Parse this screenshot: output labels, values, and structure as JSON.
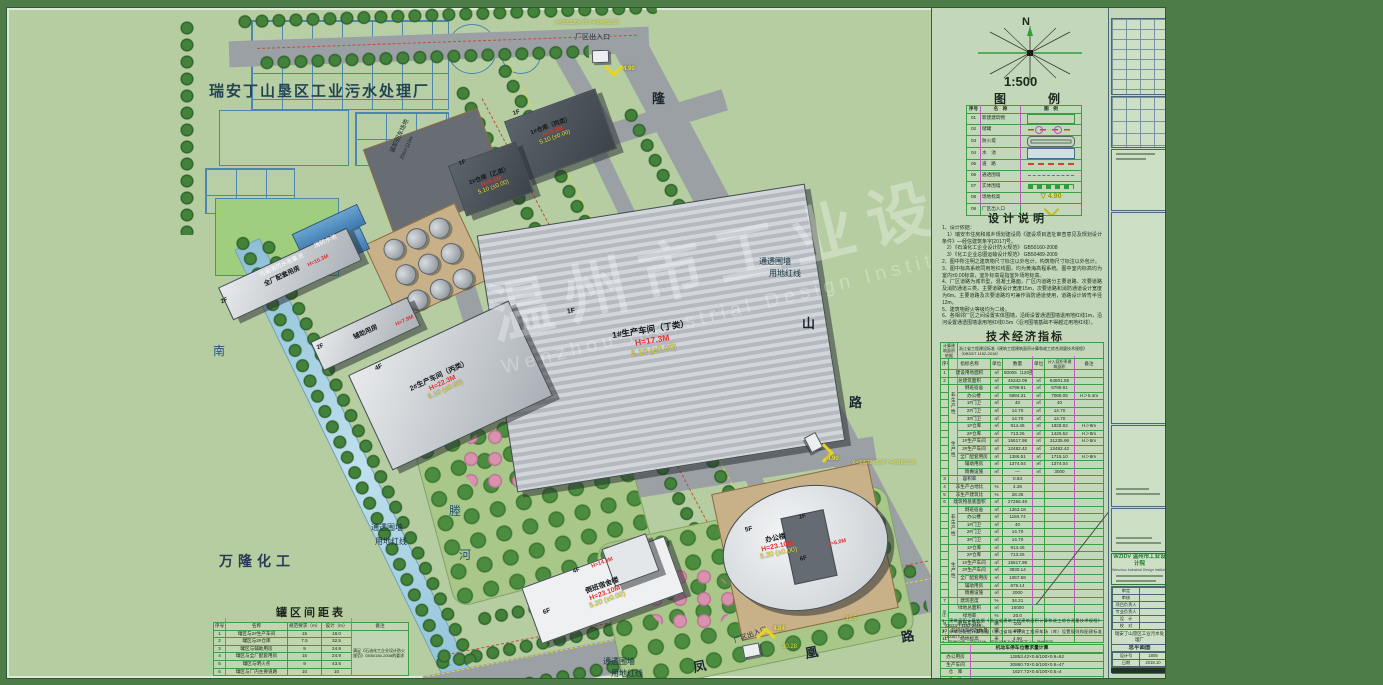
{
  "plan": {
    "site_title": "瑞安丁山垦区工业污水处理厂",
    "neighbor": "万隆化工",
    "river_chars": [
      "南",
      "塍",
      "河"
    ],
    "road_longshan": [
      "隆",
      "山",
      "路"
    ],
    "road_fenghuang": [
      "凤",
      "凰",
      "路"
    ],
    "loading_area": "装卸回车场地",
    "loading_size": "20m×110m",
    "fence_label": "通透围墙",
    "redline_label": "用地红线",
    "entrance_label": "厂区出入口",
    "pool1": "消防水池",
    "pool2": "污染消防水收集池",
    "marks": {
      "m1": "4.90",
      "m2": "4.84",
      "m3": "4.90"
    },
    "dims": {
      "d1": "30.28",
      "d2": "39.5"
    },
    "coords": {
      "c1": "X=3058204.78 Y=494655.96",
      "c2": "X=3057243.34 Y=494857.96"
    },
    "buildings": [
      {
        "floors": "1F",
        "name": "1#仓库（丙类）",
        "h": "H=9.2M",
        "elev": "5.10",
        "elev0": "(±0.00)"
      },
      {
        "floors": "1F",
        "name": "2#仓库（乙类）",
        "h": "H=9.2M",
        "elev": "5.10",
        "elev0": "(±0.00)"
      },
      {
        "floors": "1F",
        "name": "1#生产车间（丁类）",
        "h": "H=17.3M",
        "elev": "5.10",
        "elev0": "(±0.00)"
      },
      {
        "floors": "4F",
        "name": "2#生产车间（丙类）",
        "h": "H=22.3M",
        "elev": "5.10",
        "elev0": "(±0.00)"
      },
      {
        "floors": "2F",
        "name": "全厂配套用房",
        "h": "H=10.3M",
        "elev": "5.10",
        "elev0": "(±0.00)"
      },
      {
        "floors": "2F",
        "name": "辅助用房",
        "h": "H=7.9M",
        "elev": "5.10",
        "elev0": "(±0.00)"
      },
      {
        "floors": "6F",
        "name": "倒班宿舍楼",
        "h": "H=23.10M",
        "elev": "5.20",
        "elev0": "(±0.00)"
      },
      {
        "floors": "5F",
        "name": "办公楼",
        "h": "H=23.10M",
        "elev": "5.20",
        "elev0": "(±0.00)"
      },
      {
        "floors": "4F",
        "name": "",
        "h": "H=14.3M",
        "elev": "",
        "elev0": ""
      },
      {
        "floors": "1F",
        "name": "",
        "h": "H=6.0M",
        "elev": "",
        "elev0": ""
      },
      {
        "floors": "6F",
        "name": "",
        "h": "",
        "elev": "",
        "elev0": ""
      }
    ],
    "watermark_cn": "温州市工业设计院",
    "watermark_en": "Wenzhou Industrial Design Institute"
  },
  "panel": {
    "north": "N",
    "scale": "1:500",
    "legend_title": "图　　例",
    "legend_headers": [
      "序号",
      "名　称",
      "图　例"
    ],
    "legend_rows": [
      {
        "no": "01",
        "name": "新建建筑物",
        "sym": "new-building",
        "sym_text": ""
      },
      {
        "no": "02",
        "name": "储罐",
        "sym": "tank",
        "sym_text": ""
      },
      {
        "no": "03",
        "name": "防火堤",
        "sym": "fire-dike",
        "sym_text": ""
      },
      {
        "no": "04",
        "name": "水　池",
        "sym": "pool",
        "sym_text": ""
      },
      {
        "no": "05",
        "name": "道　路",
        "sym": "road",
        "sym_text": ""
      },
      {
        "no": "06",
        "name": "通透围墙",
        "sym": "transparent-fence",
        "sym_text": ""
      },
      {
        "no": "07",
        "name": "实体围墙",
        "sym": "solid-fence",
        "sym_text": ""
      },
      {
        "no": "08",
        "name": "场地标高",
        "sym": "site-elevation",
        "sym_text": "4.90"
      },
      {
        "no": "09",
        "name": "厂区出入口",
        "sym": "entrance",
        "sym_text": ""
      }
    ],
    "notes_title": "设计说明",
    "notes": [
      "1、设计依据：",
      "　1）瑞安市住房和城乡规划建设局《建设项目选址审查意见及规划设计条件》—经信建筑条字[2017]号。",
      "　2）《石油化工企业设计防火规范》 GB50160-2008",
      "　3）《化工企业总图运输设计规范》 GB50489-2009",
      "2、图中所注明之建筑物尺寸标注以外包计，构筑物尺寸标注以外包计。",
      "3、图中标高系统同用地红线图，均为黄海高程系统。图中室内标高均为室内±0.00标高，室外标高是指室外场地标高。",
      "4、厂区道路为城市型，混凝土路面，厂区内道路分主要道路、次要道路及消防通道三类。主要道路设计宽度15m，次要道路和消防通道设计宽度为6m。主要道路及次要道路均可兼作消防通道使用，道路设计转弯半径12m。",
      "5、建筑物耐火等级均为二级。",
      "6、各相邻厂区之间设置实体围墙，沿街设置通透围墙退用地红线1m，沿河设置通透围墙退用地红线0.5m（沿河围墙基础不得越过用地红线）。",
      "7、图中坐标、尺寸和标高单位均注明外，均以米计。",
      "8、本图为工程规划许可证审图。"
    ],
    "tech_title": "技术经济指标",
    "tech_rows": [
      [
        {
          "t": "计算建筑面积依据",
          "cs": 2,
          "cls": "tiny"
        },
        {
          "t": "浙江省工程建设标准《建筑工程建筑面积计算和竣工综合测量技术规程》（DB33/T 1152-2018）",
          "cs": 6,
          "cls": "tiny left"
        }
      ],
      [
        "序号",
        {
          "t": "指标名称",
          "cs": 2
        },
        "单位",
        "数量",
        "单位",
        {
          "t": "计入容积率建筑面积",
          "cls": "tiny"
        },
        "备注"
      ],
      [
        "1",
        {
          "t": "建设用地面积",
          "cs": 2
        },
        "㎡",
        "80005（120亩）",
        "",
        "",
        ""
      ],
      [
        "2",
        {
          "t": "总建筑面积",
          "cs": 2
        },
        "㎡",
        "45342.09",
        "㎡",
        "64801.55",
        ""
      ],
      [
        "",
        {
          "t": "非生产性",
          "rs": 5,
          "cls": "vert"
        },
        "倒班宿舍",
        "㎡",
        "6799.91",
        "㎡",
        "6799.91",
        ""
      ],
      [
        "",
        "办公楼",
        "㎡",
        "5984.31",
        "㎡",
        "7068.05",
        "H＞5.4m"
      ],
      [
        "",
        "1#门卫",
        "㎡",
        "40",
        "㎡",
        "40",
        ""
      ],
      [
        "",
        "2#门卫",
        "㎡",
        "14.70",
        "㎡",
        "14.70",
        ""
      ],
      [
        "",
        "3#门卫",
        "㎡",
        "14.70",
        "㎡",
        "14.70",
        ""
      ],
      [
        "",
        {
          "t": "生产性",
          "rs": 7,
          "cls": "vert"
        },
        "1#仓库",
        "㎡",
        "914.46",
        "㎡",
        "1828.92",
        "H＞8m"
      ],
      [
        "",
        "2#仓库",
        "㎡",
        "713.26",
        "㎡",
        "1426.52",
        "H＞8m"
      ],
      [
        "",
        "1#生产车间",
        "㎡",
        "15617.98",
        "㎡",
        "31235.96",
        "H＞8m"
      ],
      [
        "",
        "2#生产车间",
        "㎡",
        "12482.42",
        "㎡",
        "12482.42",
        ""
      ],
      [
        "",
        "全厂配套用房",
        "㎡",
        "1386.51",
        "㎡",
        "1715.10",
        "H＞8m"
      ],
      [
        "",
        "辅助用房",
        "㎡",
        "1374.04",
        "㎡",
        "1374.04",
        ""
      ],
      [
        "",
        "雨棚设施",
        "㎡",
        "—",
        "㎡",
        "3000",
        ""
      ],
      [
        "3",
        {
          "t": "容积率",
          "cs": 2
        },
        "",
        "0.84",
        "",
        "",
        ""
      ],
      [
        "4",
        {
          "t": "非生产占地比",
          "cs": 2
        },
        "%",
        "4.26",
        "",
        "",
        ""
      ],
      [
        "5",
        {
          "t": "非生产建筑比",
          "cs": 2
        },
        "%",
        "28.35",
        "",
        "",
        ""
      ],
      [
        "6",
        {
          "t": "建筑物基底面积",
          "cs": 2
        },
        "㎡",
        "27266.48",
        "",
        "",
        ""
      ],
      [
        "",
        {
          "t": "非生产性",
          "rs": 5,
          "cls": "vert"
        },
        "倒班宿舍",
        "㎡",
        "1363.18",
        "",
        "",
        ""
      ],
      [
        "",
        "办公楼",
        "㎡",
        "1184.74",
        "",
        "",
        ""
      ],
      [
        "",
        "1#门卫",
        "㎡",
        "40",
        "",
        "",
        ""
      ],
      [
        "",
        "2#门卫",
        "㎡",
        "14.70",
        "",
        "",
        ""
      ],
      [
        "",
        "3#门卫",
        "㎡",
        "14.70",
        "",
        "",
        ""
      ],
      [
        "",
        {
          "t": "生产性",
          "rs": 7,
          "cls": "vert"
        },
        "1#仓库",
        "㎡",
        "914.46",
        "",
        "",
        ""
      ],
      [
        "",
        "2#仓库",
        "㎡",
        "713.26",
        "",
        "",
        ""
      ],
      [
        "",
        "1#生产车间",
        "㎡",
        "15617.98",
        "",
        "",
        ""
      ],
      [
        "",
        "2#生产车间",
        "㎡",
        "3930.14",
        "",
        "",
        ""
      ],
      [
        "",
        "全厂配套用房",
        "㎡",
        "1067.58",
        "",
        "",
        ""
      ],
      [
        "",
        "辅助用房",
        "㎡",
        "676.14",
        "",
        "",
        ""
      ],
      [
        "",
        "雨棚设施",
        "㎡",
        "2000",
        "",
        "",
        ""
      ],
      [
        "7",
        {
          "t": "建筑密度",
          "cs": 2
        },
        "%",
        "34.21",
        "",
        "",
        ""
      ],
      [
        {
          "t": "8",
          "rs": 2
        },
        {
          "t": "绿地总面积",
          "cs": 2
        },
        "㎡",
        "16000",
        "",
        "",
        ""
      ],
      [
        {
          "t": "绿地率",
          "cs": 2
        },
        "%",
        "20.0",
        "",
        "",
        ""
      ],
      [
        "9",
        {
          "t": "机动车泊位",
          "cs": 2
        },
        "辆",
        "103",
        "",
        "",
        ""
      ],
      [
        "10",
        {
          "t": "非机动车停放数量",
          "cs": 2
        },
        "辆",
        "200",
        "",
        "",
        ""
      ],
      [
        "11",
        {
          "t": "场地标高",
          "cs": 2
        },
        "米",
        "4.90",
        "",
        "",
        ""
      ]
    ],
    "tech_notes": [
      "注：",
      "1、建筑面积计算依据《浙江省建筑工程建筑面积计算和竣工综合测量技术规程》（DB33/T 1152-2018）。",
      "2、停车位配置计算依据《浙江省城市建筑工程停车场（库）设置规则和配建标准（2016）》。",
      "3、雨棚设施、室外场地、室外设备及管线等不计入建筑面积。",
      "4、停车位计算方法详见下表。"
    ],
    "parking_title": "机动车停车位需求量计算",
    "parking_rows": [
      [
        "办公用房",
        "12853.42×0.6/100×0.9=52"
      ],
      [
        "生产车间",
        "30860.70×0.5/100×0.9=47"
      ],
      [
        "仓　库",
        "1627.72×0.6/100×0.5=4"
      ],
      [
        "合　计",
        "52+47+4=103"
      ]
    ]
  },
  "tank_table": {
    "title": "罐区间距表",
    "rows": [
      [
        "序号",
        "名称",
        "规范要求（m）",
        "设计（m）",
        "备注"
      ],
      [
        "1",
        "罐区与2#生产车间",
        "15",
        "18.0",
        {
          "t": "满足《石油化工企业设计防火规范》GB50160-2008的要求",
          "rs": 6,
          "cls": "tiny left"
        }
      ],
      [
        "2",
        "罐区与2#仓库",
        "7.5",
        "32.5"
      ],
      [
        "3",
        "罐区与辅助用房",
        "9",
        "24.9"
      ],
      [
        "4",
        "罐区与全厂配套用房",
        "15",
        "24.9"
      ],
      [
        "5",
        "罐区与明火点",
        "9",
        "43.5"
      ],
      [
        "6",
        "罐区与厂内主要道路",
        "10",
        "10"
      ]
    ]
  },
  "strip": {
    "logo": "WZIDV 温州市工业设计院",
    "logo_en": "Wenzhou Industrial Design Institute",
    "roles": [
      "审定",
      "审核",
      "项目负责人",
      "专业负责人",
      "设　计",
      "校　对"
    ],
    "project": "瑞安丁山垦区工业污水处理厂",
    "drawing": "总平面图",
    "no_label": "设计号",
    "no": "1805",
    "date_label": "日期",
    "date": "2018.10",
    "scale_label": "比例",
    "scale": "1:500"
  }
}
